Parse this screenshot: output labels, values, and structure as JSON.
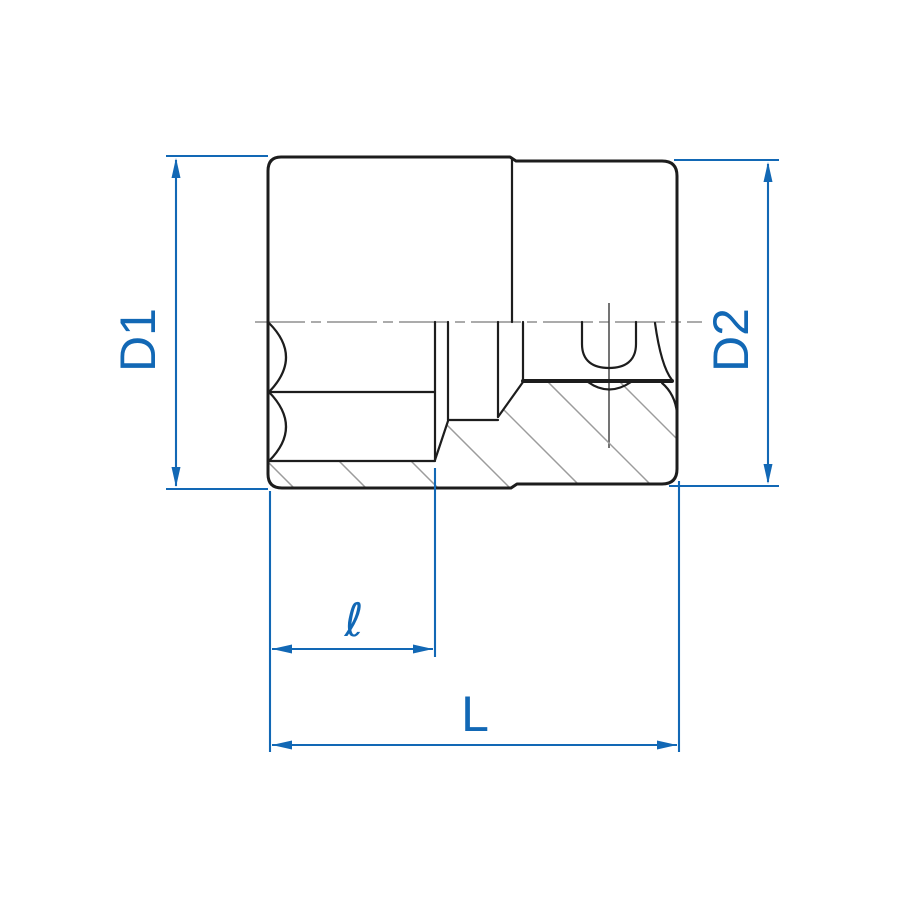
{
  "drawing": {
    "kind": "socket-cross-section-technical-drawing",
    "labels": {
      "d1": "D1",
      "d2": "D2",
      "hex_depth": "ℓ",
      "overall_length": "L"
    },
    "colors": {
      "dimension_blue": "#1268b5",
      "outline_black": "#1d1d1d",
      "centerline_gray": "#8f8f8f",
      "hatch_gray": "#9c9c9c",
      "background": "#ffffff"
    }
  }
}
